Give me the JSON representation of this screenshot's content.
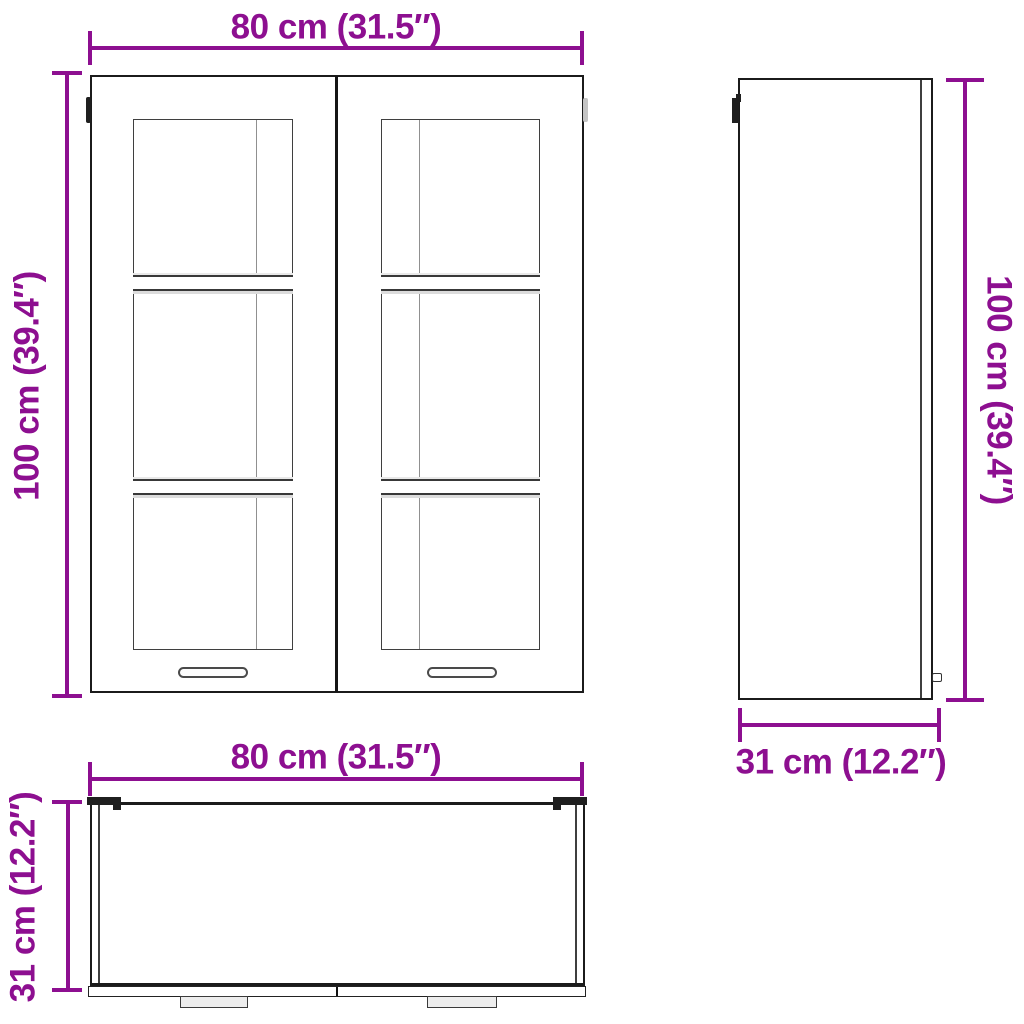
{
  "diagram_title": "Wall cabinet dimension drawing, three orthographic views",
  "accent_color": "#8d0f90",
  "line_color": "#1b1b1b",
  "views": {
    "front": {
      "width_label": "80 cm (31.5″)",
      "height_label": "100 cm (39.4″)"
    },
    "side": {
      "height_label": "100 cm (39.4″)",
      "depth_label": "31 cm (12.2″)"
    },
    "top": {
      "width_label": "80 cm (31.5″)",
      "depth_label": "31 cm (12.2″)"
    }
  }
}
